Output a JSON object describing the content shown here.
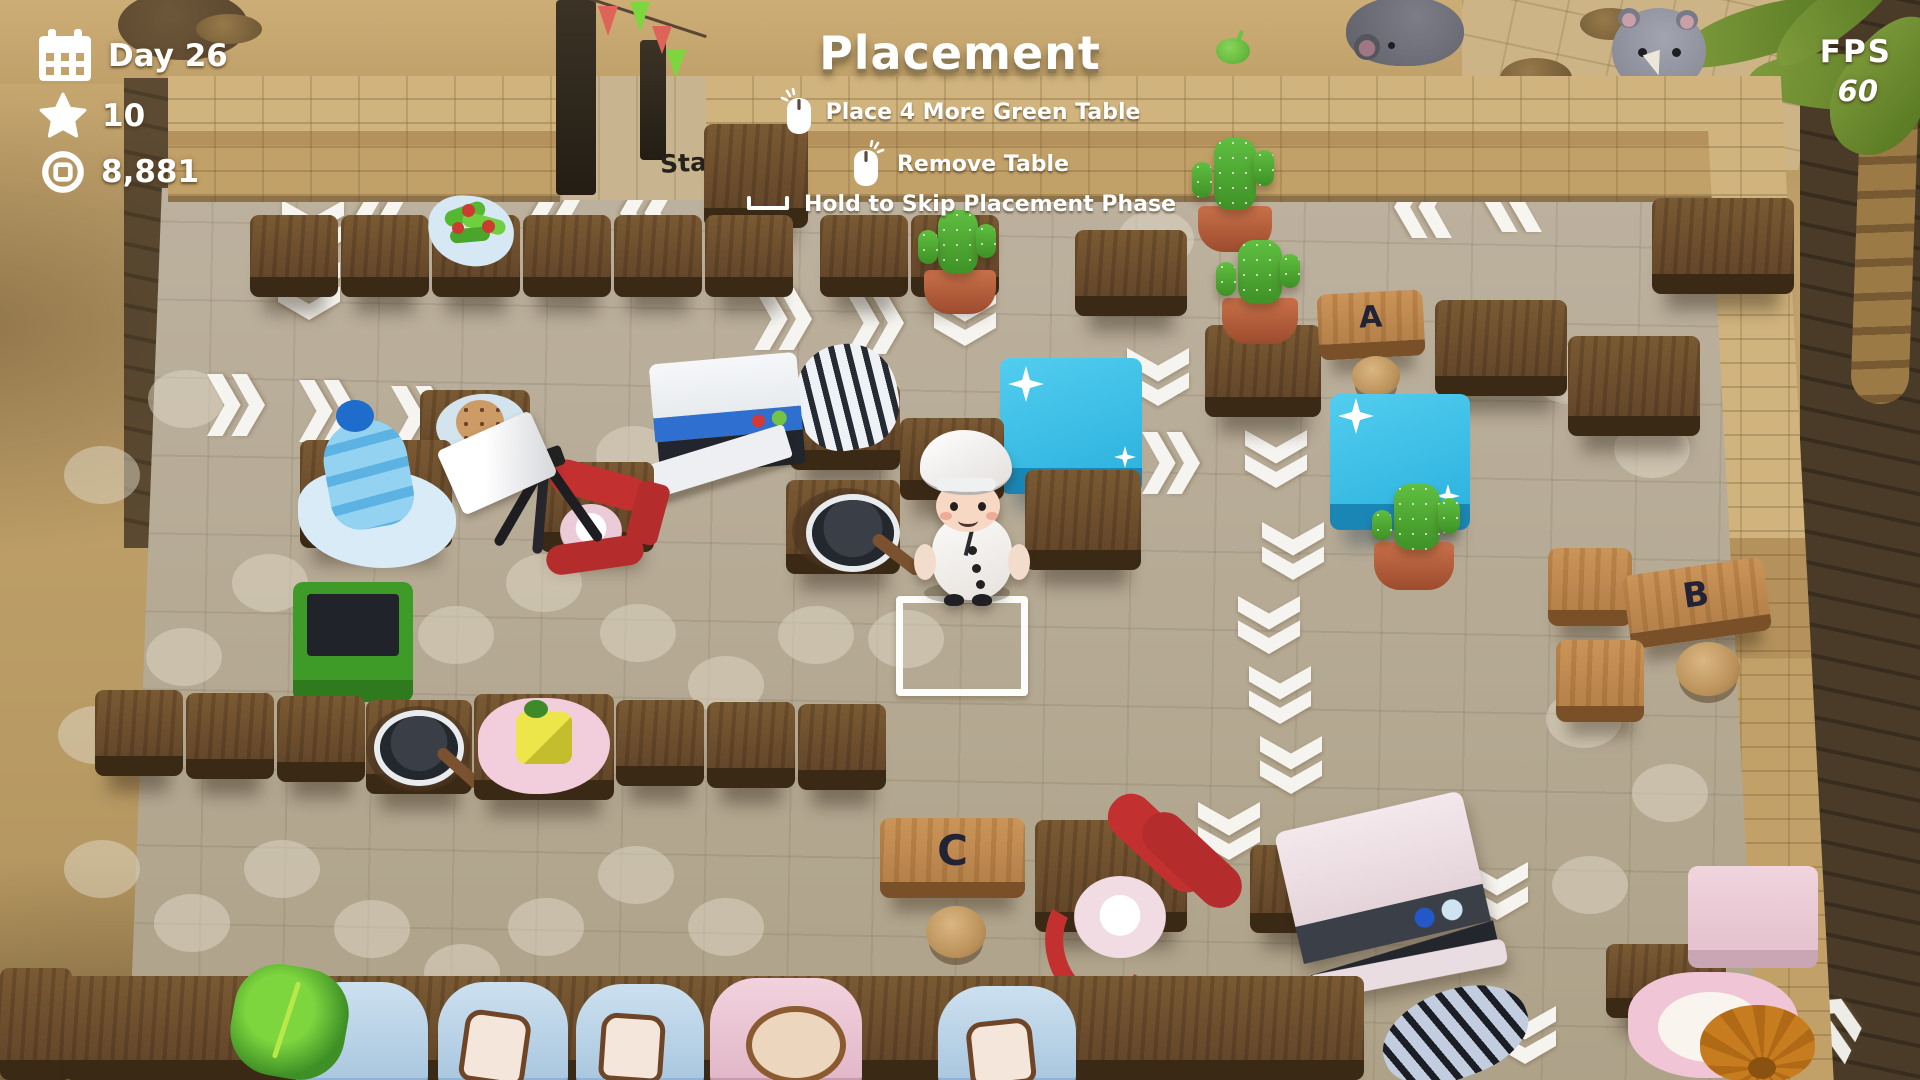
{
  "hud": {
    "day": "Day 26",
    "stars": "10",
    "coins": "8,881"
  },
  "header": {
    "title": "Placement"
  },
  "instructions": [
    {
      "icon": "mouse-left-click-icon",
      "label": "Place 4 More Green Table"
    },
    {
      "icon": "mouse-right-click-icon",
      "label": "Remove Table"
    },
    {
      "icon": "spacebar-icon",
      "label": "Hold to Skip Placement Phase"
    }
  ],
  "fps": {
    "label": "FPS",
    "value": "60"
  },
  "floor": {
    "start": "Start",
    "table_a": "A",
    "table_b": "B",
    "table_c": "C"
  },
  "colors": {
    "hud_text": "#ffffff",
    "counter_wood": "#6e4f2b",
    "light_wood": "#c08c54",
    "blue_table": "#35bde4",
    "cactus_green": "#53b13a",
    "pot_terracotta": "#b85f3f",
    "mixer_red": "#c23030",
    "trash_green": "#3f9b28",
    "dishwasher_blue": "#2f6fd0",
    "arrow_white": "#ffffff",
    "sand": "#c2a36b",
    "floor_tile": "#b4a995",
    "table_letter": "#232336"
  }
}
